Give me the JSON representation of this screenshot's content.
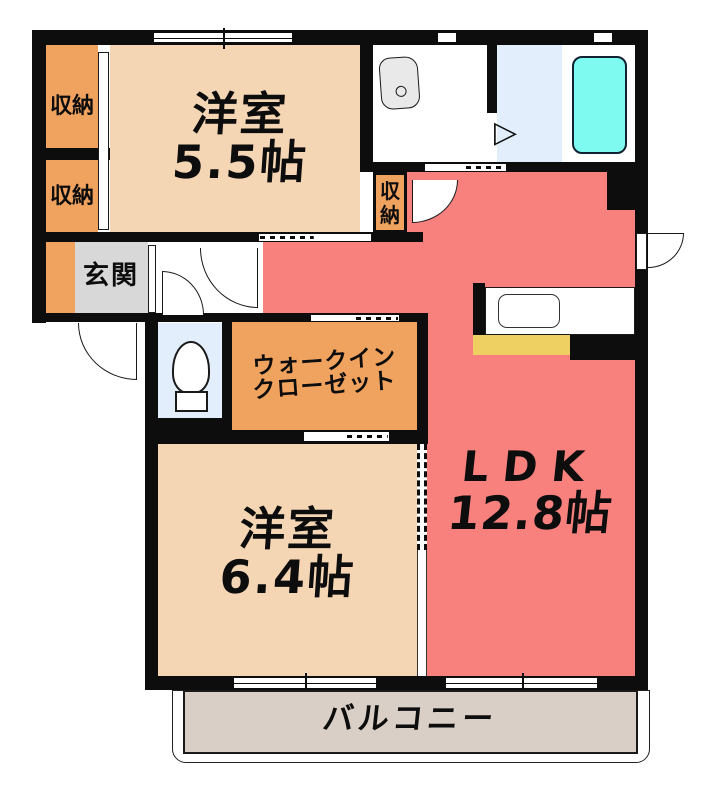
{
  "plan": {
    "type": "apartment-floor-plan",
    "rooms": {
      "bedroom_a": {
        "name": "洋室",
        "size": "5.5帖"
      },
      "bedroom_b": {
        "name": "洋室",
        "size": "6.4帖"
      },
      "ldk": {
        "name": "LDK",
        "size": "12.8帖"
      },
      "walk_in_closet": {
        "line1": "ウォークイン",
        "line2": "クローゼット"
      },
      "entrance": {
        "name": "玄関"
      },
      "balcony": {
        "name": "バルコニー"
      },
      "storage_top": {
        "name": "収納"
      },
      "storage_bottom": {
        "name": "収納"
      },
      "storage_hall": {
        "char1": "収",
        "char2": "納"
      }
    },
    "fixtures": {
      "bathtub": "bathtub",
      "wash_basin": "wash-basin",
      "toilet": "toilet",
      "kitchen_sink": "kitchen-sink",
      "bath_door_glyph": "▷"
    },
    "colors": {
      "wall": "#0d0d0d",
      "bedroom": "#f5d6b4",
      "storage": "#f0a25f",
      "ldk": "#f8817e",
      "entrance_floor": "#d8d8d8",
      "wet_floor": "#e2eefb",
      "bathtub": "#7efaf0",
      "kitchen_counter_edge": "#eecf62",
      "balcony_floor": "#d9cfc6"
    }
  }
}
